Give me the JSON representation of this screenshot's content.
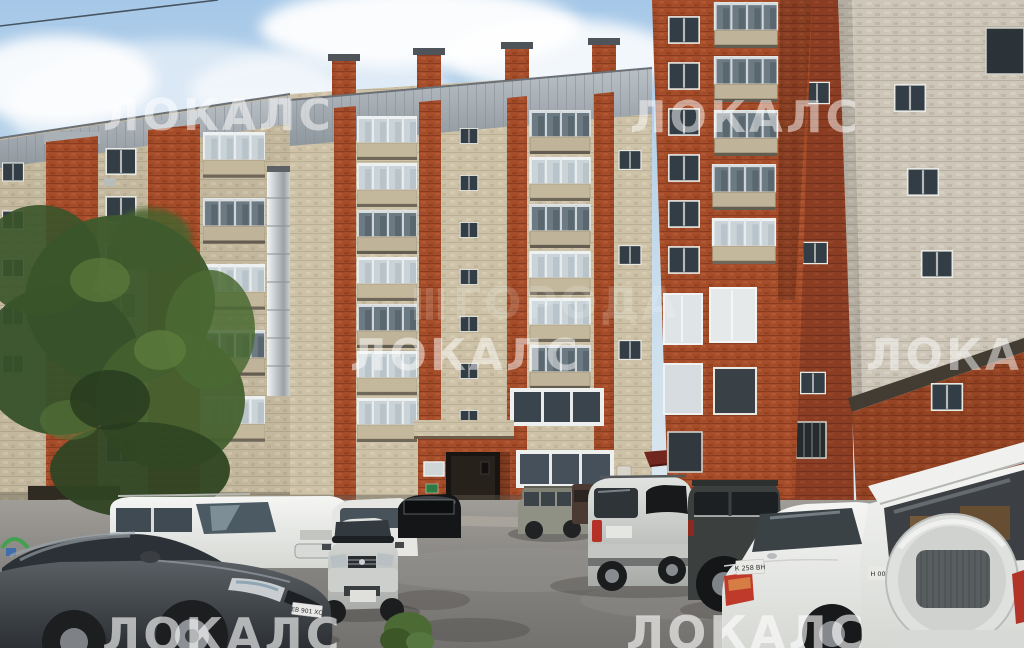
{
  "image": {
    "kind": "photograph",
    "subject": "Courtyard of a multi-storey beige-and-red brick apartment building with cars parked on asphalt, listing-site watermarks overlaid",
    "width_px": 1024,
    "height_px": 648
  },
  "watermarks": {
    "brand": "ЛОКАЛС",
    "center_brand": "ГОРОДА",
    "items": [
      {
        "name": "watermark-locals-top-left",
        "text": "ЛОКАЛС",
        "x": 103,
        "y": 94,
        "size": 44,
        "opacity": 0.5
      },
      {
        "name": "watermark-locals-top-right",
        "text": "ЛОКАЛС",
        "x": 630,
        "y": 96,
        "size": 44,
        "opacity": 0.5
      },
      {
        "name": "watermark-locals-mid-left",
        "text": "ЛОКАЛС",
        "x": 350,
        "y": 334,
        "size": 44,
        "opacity": 0.5
      },
      {
        "name": "watermark-locals-mid-right",
        "text": "ЛОКАЛС",
        "x": 866,
        "y": 334,
        "size": 44,
        "opacity": 0.5
      },
      {
        "name": "watermark-locals-bottom-left",
        "text": "ЛОКАЛС",
        "x": 102,
        "y": 612,
        "size": 46,
        "opacity": 0.62
      },
      {
        "name": "watermark-locals-bottom-center",
        "text": "ЛОКАЛС",
        "x": 626,
        "y": 610,
        "size": 46,
        "opacity": 0.62
      },
      {
        "name": "watermark-goroda-center",
        "text": "ГОРОДА",
        "x": 414,
        "y": 282,
        "size": 44,
        "opacity": 0.16,
        "icon": true
      }
    ]
  },
  "license_plates": {
    "dark_sedan_front": "ЕВ 901 ХС",
    "white_sedan_rear": "К 258 ВН",
    "white_suv_rear_partial": "Н 00"
  },
  "vehicles": [
    {
      "name": "dark-gray-sedan",
      "color": "#43474b"
    },
    {
      "name": "white-minivan",
      "color": "#ebece8"
    },
    {
      "name": "white-car-behind-wagon",
      "color": "#e6e7e3"
    },
    {
      "name": "black-crossover",
      "color": "#141618"
    },
    {
      "name": "silver-wagon-front-view",
      "color": "#c7c9c6"
    },
    {
      "name": "khaki-suv",
      "color": "#8f9184"
    },
    {
      "name": "dark-brown-van",
      "color": "#4a3a32"
    },
    {
      "name": "silver-tall-suv",
      "color": "#c9cbc8"
    },
    {
      "name": "dark-suv",
      "color": "#3b403e"
    },
    {
      "name": "white-sedan",
      "color": "#eceded"
    },
    {
      "name": "white-offroader-spare-wheel",
      "color": "#eef0ee"
    }
  ],
  "palette": {
    "sky_top": "#a6c8e8",
    "sky_bottom": "#e9eef0",
    "cloud": "#ffffff",
    "beige_wall": "#cdc2a7",
    "beige_wall_dark": "#c3b89d",
    "red_brick": "#a54c2a",
    "red_brick_dark": "#8a3d22",
    "gray_roof": "#a9b0b6",
    "gray_brick": "#ccc5b8",
    "asphalt": "#84827f",
    "tree_green": "#3f5a2c",
    "awning_red": "#71261f",
    "entrance_door": "#27211b",
    "watermark": "#ffffff"
  }
}
